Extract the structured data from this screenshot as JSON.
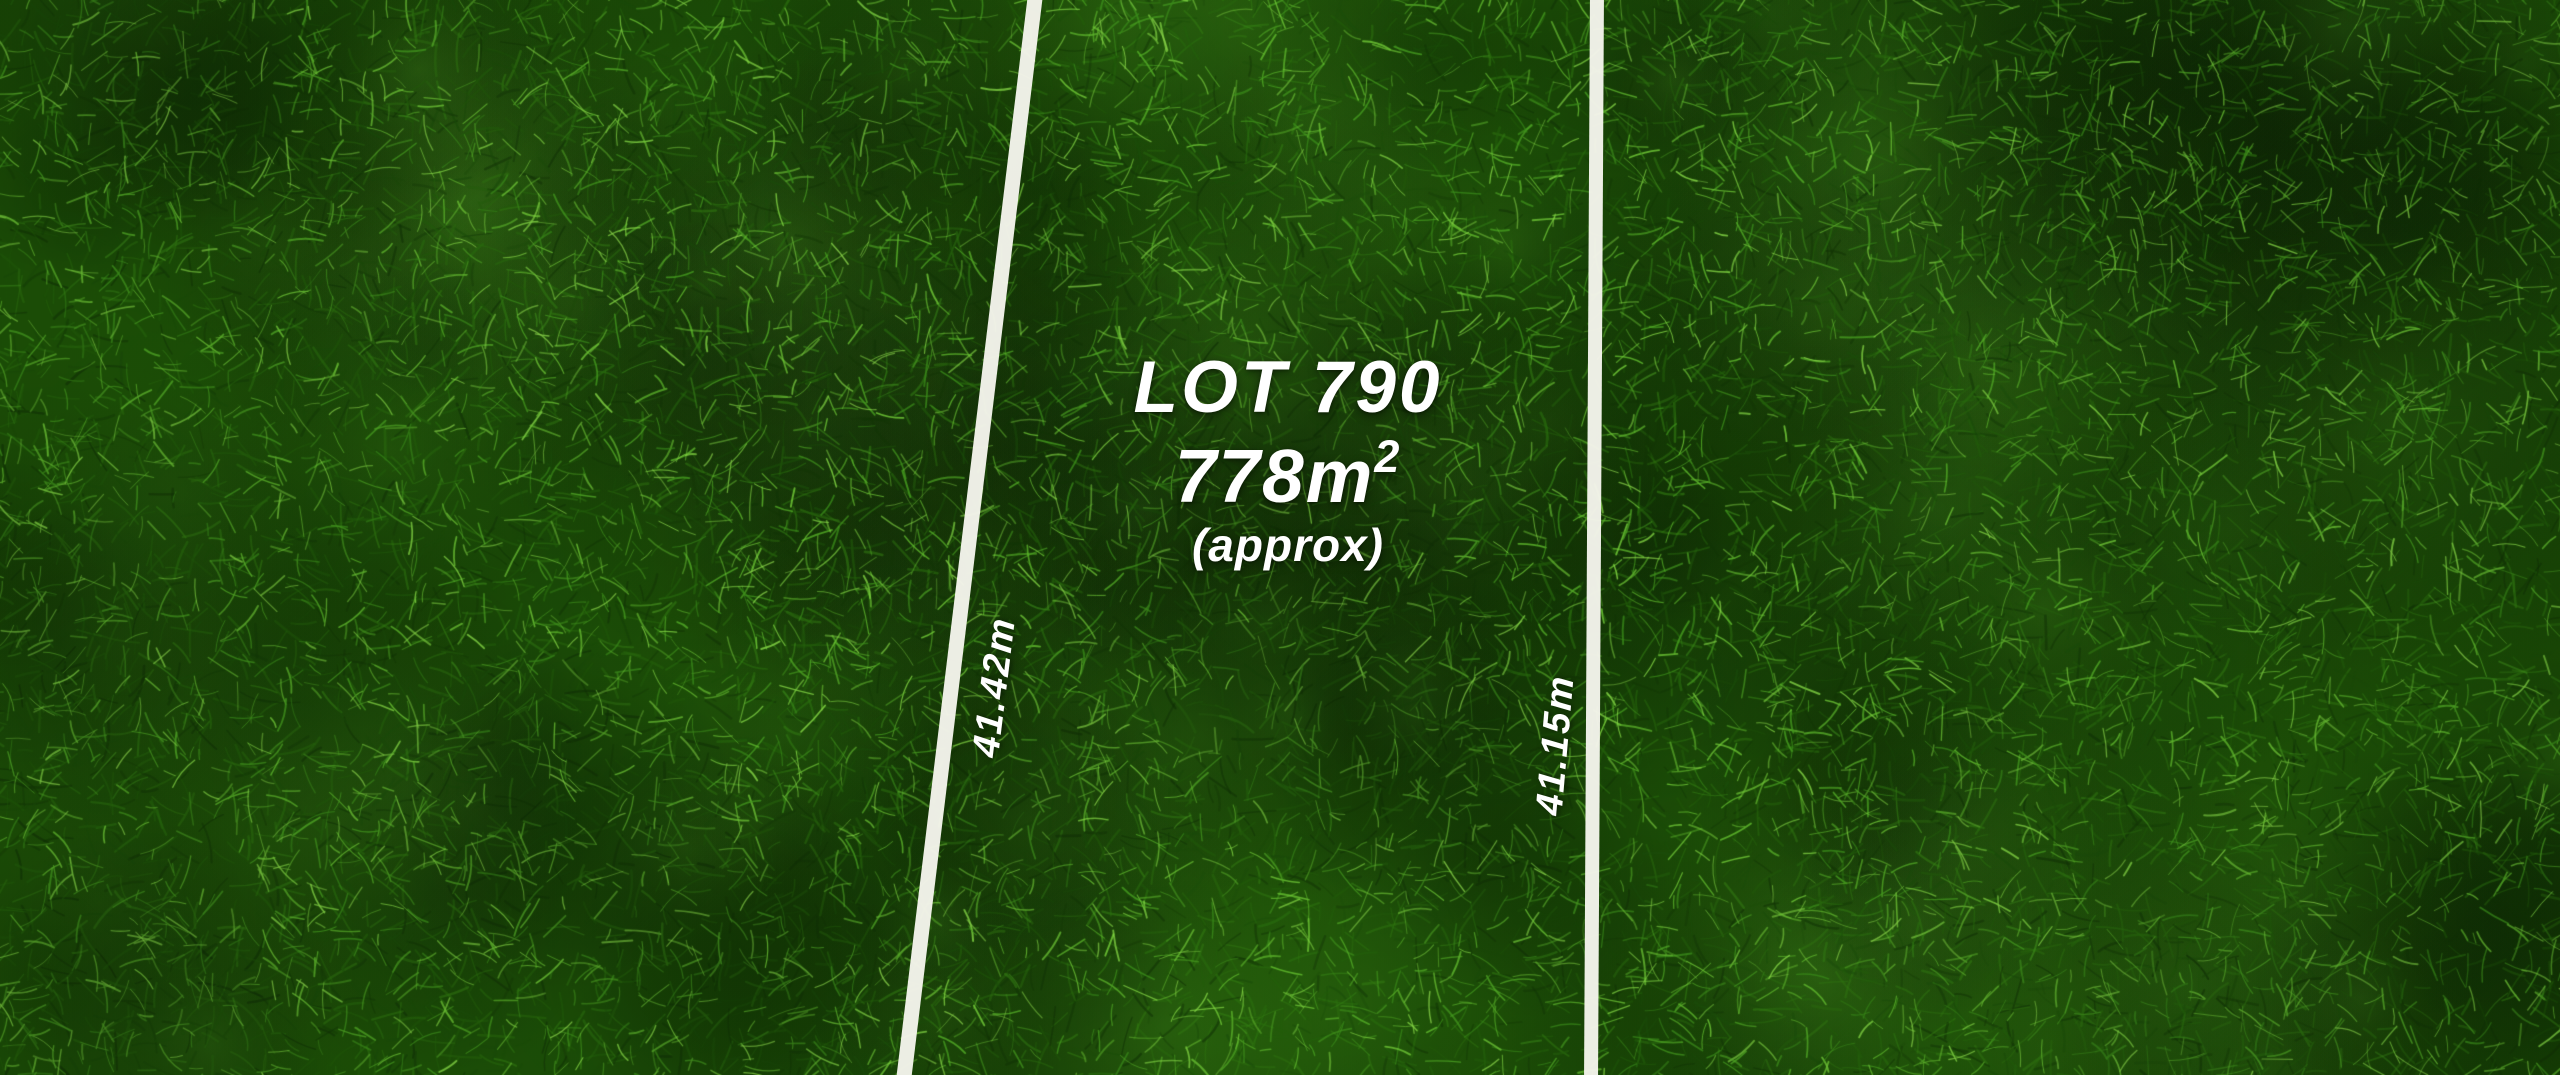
{
  "lot": {
    "title": "LOT 790",
    "area_value": "778m",
    "area_superscript": "2",
    "area_note": "(approx)"
  },
  "measurements": {
    "left_boundary": "41.42m",
    "right_boundary": "41.15m"
  },
  "colors": {
    "boundary_line": "#f4f4ec",
    "label_text": "#ffffff",
    "grass_base": "#1e5507",
    "grass_palette_dark": [
      "#123406",
      "#1b4d0a",
      "#235f0b",
      "#2b700f",
      "#327a12"
    ],
    "grass_palette_light": [
      "#3a8c1a",
      "#459c1f",
      "#52ab26",
      "#60ba2d",
      "#71ca37",
      "#85d845"
    ],
    "grass_shadow": "#061a02",
    "grass_highlight": "#8ed94c"
  }
}
